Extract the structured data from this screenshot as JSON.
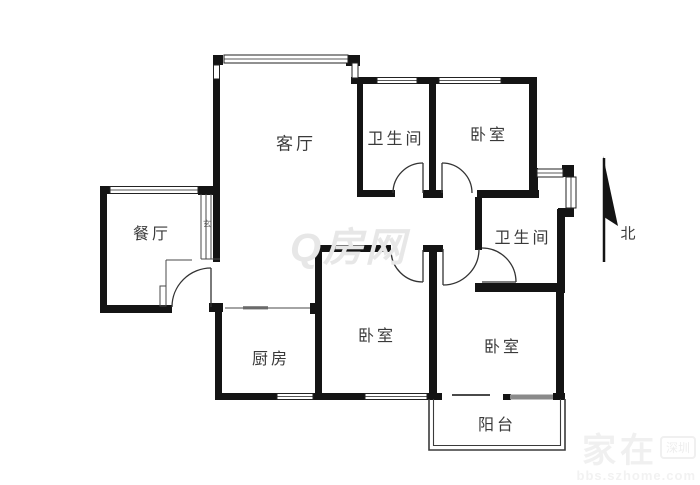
{
  "title": "三室两厅户型图",
  "rooms": {
    "living": "客厅",
    "dining": "餐厅",
    "kitchen": "厨房",
    "bath1": "卫生间",
    "bath2": "卫生间",
    "bed1": "卧室",
    "bed2": "卧室",
    "bed3": "卧室",
    "balcony": "阳台",
    "foyer": "玄"
  },
  "compass": {
    "north_label": "北"
  },
  "watermarks": {
    "center_logo": "Q房网",
    "corner_brand": "家在",
    "corner_badge": "深圳",
    "corner_site": "bbs.szhome.com"
  },
  "colors": {
    "wall": "#141414",
    "label": "#3a3a3a",
    "watermark_center": "#e7e7e7",
    "watermark_corner": "#f1f1f1"
  }
}
